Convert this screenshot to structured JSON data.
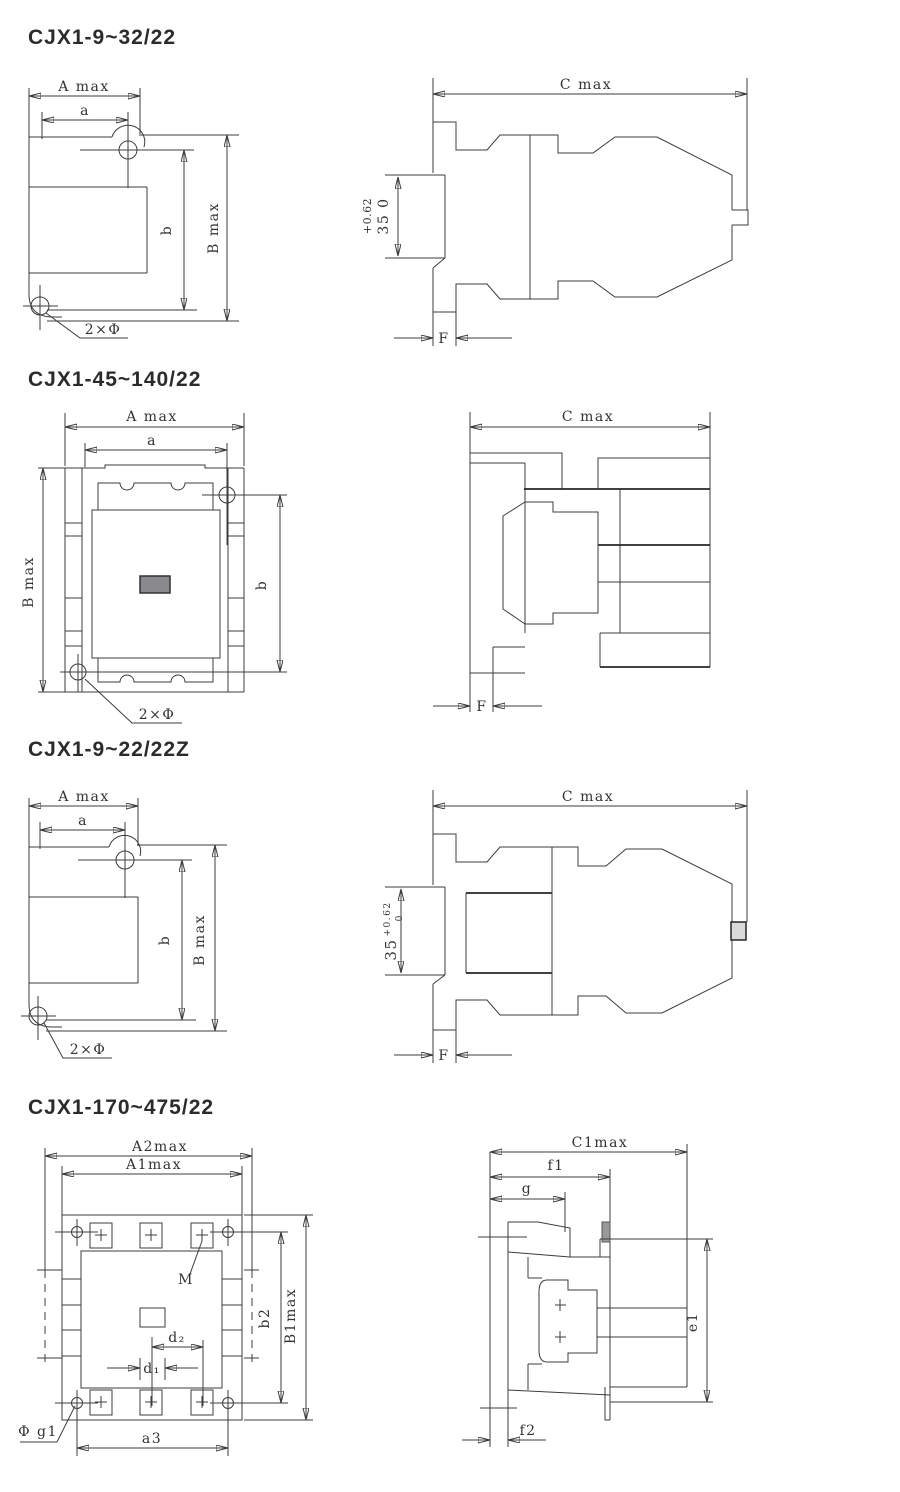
{
  "page": {
    "background": "#ffffff",
    "line_color": "#3c3c3c",
    "bold_line_color": "#262626",
    "title_color": "#2b2b2b",
    "fill_gray": "#8a8a8e",
    "fill_light_gray": "#d9d9d9",
    "fill_mid_gray": "#9a9a9a"
  },
  "sections": [
    {
      "title": "CJX1-9~32/22",
      "front": {
        "dim_A": "A max",
        "dim_a": "a",
        "dim_b": "b",
        "dim_B": "B max",
        "holes": "2×Φ"
      },
      "side": {
        "dim_C": "C max",
        "tol_line1": "+0.62",
        "tol_line2": "35 0",
        "dim_F": "F"
      }
    },
    {
      "title": "CJX1-45~140/22",
      "front": {
        "dim_A": "A max",
        "dim_a": "a",
        "dim_b": "b",
        "dim_B": "B max",
        "holes": "2×Φ"
      },
      "side": {
        "dim_C": "C max",
        "dim_F": "F"
      }
    },
    {
      "title": "CJX1-9~22/22Z",
      "front": {
        "dim_A": "A max",
        "dim_a": "a",
        "dim_b": "b",
        "dim_B": "B max",
        "holes": "2×Φ"
      },
      "side": {
        "dim_C": "C max",
        "tol_value": "35",
        "tol_sup": "+0.62",
        "tol_sub": "0",
        "dim_F": "F"
      }
    },
    {
      "title": "CJX1-170~475/22",
      "front": {
        "dim_A2": "A2max",
        "dim_A1": "A1max",
        "label_M": "M",
        "dim_d2": "d₂",
        "dim_d1": "d₁",
        "dim_a3": "a3",
        "dim_phi_g1": "Φ g1",
        "dim_b2": "b2",
        "dim_B1": "B1max"
      },
      "side": {
        "dim_C1": "C1max",
        "dim_f1": "f1",
        "dim_g": "g",
        "dim_e1": "e1",
        "dim_f2": "f2"
      }
    }
  ]
}
